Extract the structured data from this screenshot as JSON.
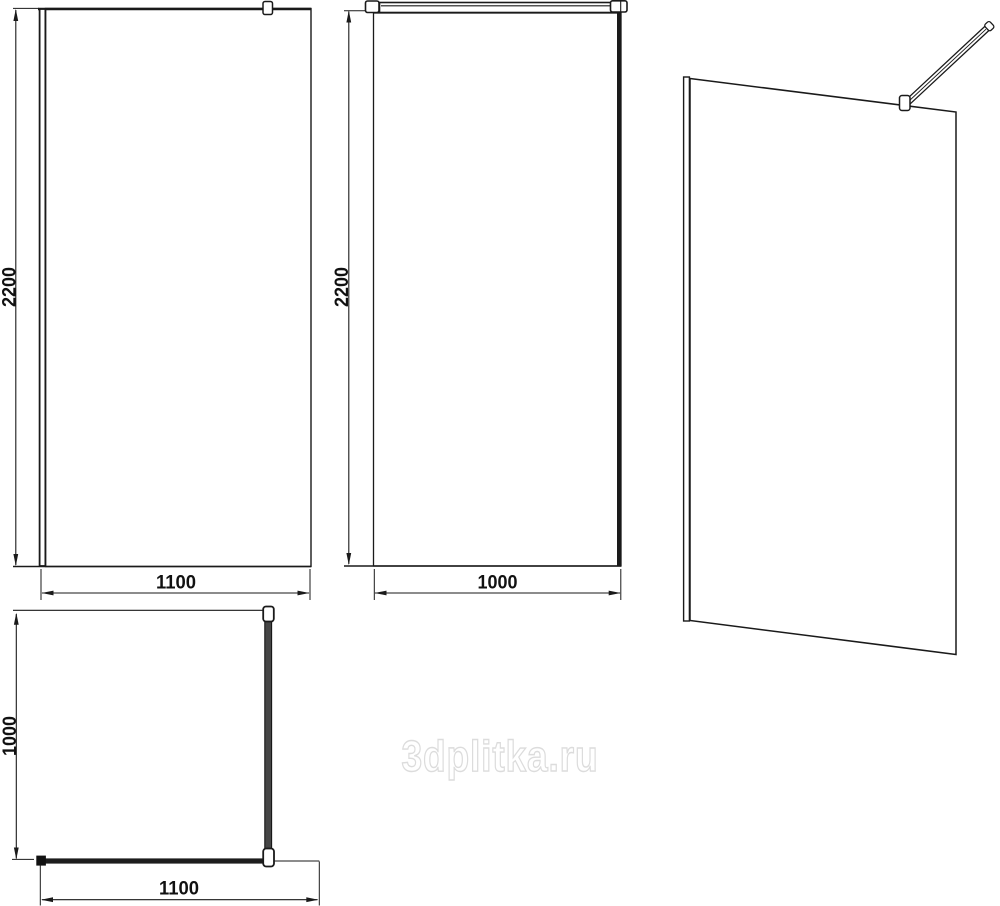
{
  "watermark": {
    "label": "3dplitka.ru"
  },
  "views": {
    "front": {
      "height_label": "2200",
      "width_label": "1100"
    },
    "side": {
      "height_label": "2200",
      "width_label": "1000"
    },
    "plan": {
      "depth_label": "1000",
      "width_label": "1100"
    }
  },
  "colors": {
    "line": "#1a1a1a",
    "support_bar_fill": "#454545",
    "watermark_outline": "#dcdcdc"
  }
}
